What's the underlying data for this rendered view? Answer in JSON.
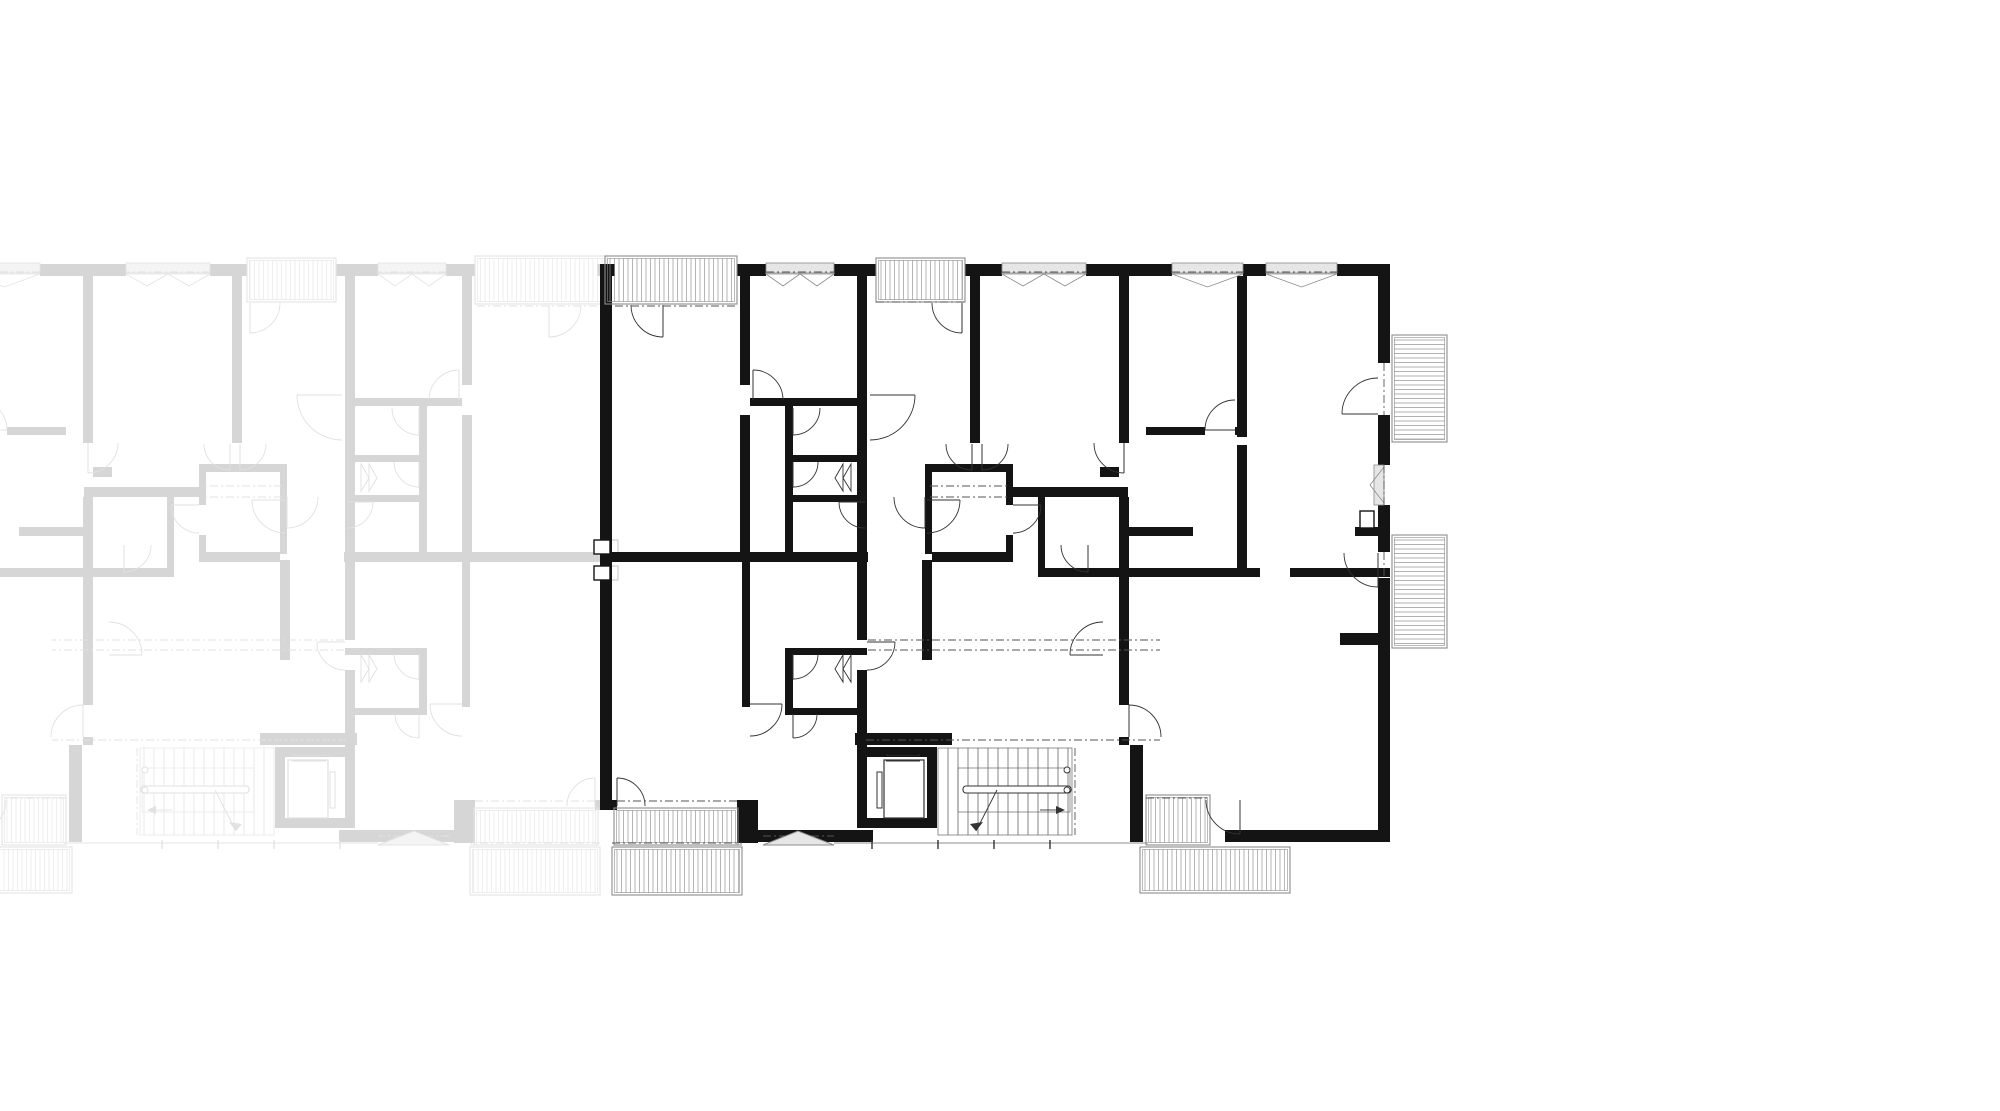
{
  "canvas": {
    "width": 2000,
    "height": 1111,
    "background": "#ffffff"
  },
  "drawing": {
    "kind": "architectural-floor-plan",
    "mirror_axis_x": 606,
    "palette": {
      "wall": "#141414",
      "line": "#333333",
      "thin": "#666666",
      "gray": "#8c8c8c",
      "grayFill": "#e6e6e6",
      "hatch": "#979797",
      "dash": "#555555",
      "faded_wall": "#d6d6d6",
      "faded_line": "#e1e1e1",
      "faded_thin": "#e5e5e5",
      "faded_gray": "#e3e3e3",
      "faded_grayFill": "#f4f4f4",
      "faded_hatch": "#e9e9e9",
      "faded_dash": "#e2e2e2"
    },
    "walls": [
      [
        600,
        264,
        12,
        546
      ],
      [
        600,
        264,
        15,
        12
      ],
      [
        737,
        264,
        29,
        12
      ],
      [
        834,
        264,
        42,
        12
      ],
      [
        965,
        264,
        37,
        12
      ],
      [
        1086,
        264,
        86,
        12
      ],
      [
        1243,
        264,
        23,
        12
      ],
      [
        1337,
        264,
        53,
        12
      ],
      [
        1378,
        264,
        12,
        99
      ],
      [
        1378,
        415,
        12,
        50
      ],
      [
        1378,
        505,
        12,
        47
      ],
      [
        1378,
        578,
        12,
        264
      ],
      [
        605,
        800,
        12,
        10
      ],
      [
        737,
        800,
        21,
        43
      ],
      [
        758,
        830,
        76,
        12
      ],
      [
        834,
        830,
        39,
        12
      ],
      [
        1225,
        830,
        165,
        12
      ],
      [
        740,
        276,
        10,
        109
      ],
      [
        740,
        415,
        10,
        137
      ],
      [
        742,
        562,
        8,
        145
      ],
      [
        857,
        276,
        10,
        286
      ],
      [
        857,
        562,
        10,
        78
      ],
      [
        857,
        670,
        10,
        158
      ],
      [
        922,
        560,
        10,
        100
      ],
      [
        970,
        276,
        10,
        167
      ],
      [
        1119,
        276,
        10,
        167
      ],
      [
        1119,
        497,
        10,
        208
      ],
      [
        1119,
        737,
        10,
        8
      ],
      [
        1130,
        745,
        13,
        97
      ],
      [
        1237,
        276,
        10,
        161
      ],
      [
        1237,
        445,
        10,
        130
      ],
      [
        605,
        552,
        263,
        10
      ],
      [
        932,
        552,
        81,
        10
      ],
      [
        925,
        464,
        88,
        8
      ],
      [
        925,
        470,
        7,
        84
      ],
      [
        1006,
        464,
        7,
        41
      ],
      [
        1006,
        535,
        7,
        27
      ],
      [
        1010,
        487,
        118,
        10
      ],
      [
        1146,
        427,
        59,
        8
      ],
      [
        1235,
        427,
        12,
        8
      ],
      [
        1128,
        527,
        65,
        9
      ],
      [
        1355,
        527,
        35,
        9
      ],
      [
        1038,
        497,
        7,
        80
      ],
      [
        1038,
        568,
        222,
        9
      ],
      [
        1290,
        568,
        100,
        9
      ],
      [
        1340,
        633,
        38,
        12
      ],
      [
        750,
        398,
        117,
        8
      ],
      [
        785,
        400,
        8,
        152
      ],
      [
        793,
        455,
        74,
        7
      ],
      [
        790,
        495,
        77,
        7
      ],
      [
        785,
        648,
        8,
        67
      ],
      [
        785,
        648,
        82,
        7
      ],
      [
        785,
        708,
        82,
        7
      ],
      [
        1100,
        467,
        19,
        10
      ],
      [
        855,
        733,
        97,
        12
      ],
      [
        927,
        747,
        10,
        81
      ],
      [
        866,
        747,
        71,
        10
      ],
      [
        866,
        818,
        71,
        10
      ]
    ],
    "outline_rects": [
      [
        594,
        540,
        16,
        14
      ],
      [
        594,
        566,
        16,
        14
      ],
      [
        1360,
        511,
        14,
        17
      ]
    ],
    "doors": [
      [
        663,
        305,
        32,
        90,
        180
      ],
      [
        962,
        303,
        30,
        90,
        180
      ],
      [
        753,
        400,
        30,
        270,
        0
      ],
      [
        793,
        408,
        27,
        90,
        0
      ],
      [
        793,
        462,
        25,
        90,
        0
      ],
      [
        865,
        502,
        26,
        180,
        90
      ],
      [
        870,
        395,
        45,
        0,
        90
      ],
      [
        972,
        444,
        26,
        90,
        180
      ],
      [
        982,
        444,
        26,
        90,
        0
      ],
      [
        1235,
        430,
        30,
        180,
        270
      ],
      [
        1378,
        414,
        36,
        180,
        270
      ],
      [
        1378,
        553,
        34,
        90,
        180
      ],
      [
        867,
        642,
        28,
        0,
        90
      ],
      [
        750,
        704,
        32,
        0,
        90
      ],
      [
        793,
        654,
        25,
        90,
        0
      ],
      [
        793,
        714,
        24,
        90,
        0
      ],
      [
        617,
        806,
        28,
        270,
        0
      ],
      [
        1240,
        800,
        34,
        90,
        180
      ],
      [
        1124,
        443,
        30,
        90,
        180
      ],
      [
        927,
        500,
        33,
        0,
        90
      ],
      [
        925,
        497,
        31,
        90,
        180
      ],
      [
        1088,
        545,
        27,
        90,
        180
      ],
      [
        1013,
        505,
        28,
        0,
        90
      ],
      [
        1103,
        655,
        33,
        180,
        270
      ],
      [
        1129,
        737,
        32,
        270,
        0
      ]
    ],
    "folds": [
      [
        843,
        464,
        843,
        491,
        835,
        478
      ],
      [
        851,
        464,
        851,
        491,
        843,
        478
      ],
      [
        843,
        655,
        843,
        682,
        835,
        669
      ],
      [
        851,
        655,
        851,
        682,
        843,
        669
      ]
    ],
    "balconies": [
      {
        "x": 605,
        "y": 256,
        "w": 132,
        "h": 48,
        "dir": "v"
      },
      {
        "x": 876,
        "y": 258,
        "w": 89,
        "h": 44,
        "dir": "v"
      },
      {
        "x": 1392,
        "y": 335,
        "w": 55,
        "h": 107,
        "dir": "h"
      },
      {
        "x": 1392,
        "y": 535,
        "w": 55,
        "h": 113,
        "dir": "h"
      },
      {
        "x": 614,
        "y": 808,
        "w": 124,
        "h": 37,
        "dir": "v"
      },
      {
        "x": 612,
        "y": 847,
        "w": 130,
        "h": 48,
        "dir": "v"
      },
      {
        "x": 1146,
        "y": 795,
        "w": 64,
        "h": 50,
        "dir": "v"
      },
      {
        "x": 1140,
        "y": 847,
        "w": 150,
        "h": 46,
        "dir": "v"
      }
    ],
    "windows": [
      {
        "x": 766,
        "y": 266,
        "w": 68,
        "tri": 2
      },
      {
        "x": 1002,
        "y": 266,
        "w": 84,
        "tri": 2
      },
      {
        "x": 1172,
        "y": 266,
        "w": 71,
        "tri": 1
      },
      {
        "x": 1266,
        "y": 266,
        "w": 71,
        "tri": 1
      },
      {
        "x": 1374,
        "y": 465,
        "h": 40,
        "tri": 1,
        "vert": true
      }
    ],
    "dashdot": [
      [
        615,
        306,
        737,
        306
      ],
      [
        876,
        302,
        965,
        302
      ],
      [
        766,
        272,
        834,
        272
      ],
      [
        1002,
        272,
        1086,
        272
      ],
      [
        1172,
        272,
        1243,
        272
      ],
      [
        1266,
        272,
        1337,
        272
      ],
      [
        1384,
        363,
        1384,
        415
      ],
      [
        1384,
        465,
        1384,
        505
      ],
      [
        1384,
        552,
        1384,
        578
      ],
      [
        868,
        640,
        1160,
        640
      ],
      [
        868,
        650,
        1160,
        650
      ],
      [
        866,
        740,
        1160,
        740
      ],
      [
        1075,
        748,
        1075,
        835
      ],
      [
        617,
        801,
        737,
        801
      ],
      [
        612,
        843,
        742,
        843
      ],
      [
        1146,
        798,
        1210,
        798
      ],
      [
        763,
        836,
        834,
        836
      ],
      [
        930,
        486,
        1010,
        486
      ],
      [
        930,
        497,
        1010,
        497
      ]
    ],
    "thin_lines": [
      [
        834,
        843,
        1148,
        843
      ],
      [
        614,
        845,
        742,
        845
      ]
    ],
    "ticks": [
      [
        872,
        840,
        872,
        849
      ],
      [
        938,
        840,
        938,
        849
      ],
      [
        994,
        840,
        994,
        849
      ],
      [
        1050,
        840,
        1050,
        849
      ]
    ],
    "stairs": {
      "x": 938,
      "y": 748,
      "w": 134,
      "h": 87,
      "step": 10,
      "landing": [
        958,
        768,
        112,
        44
      ],
      "rail": {
        "x": 963,
        "y": 786,
        "w": 108,
        "h": 7
      },
      "circles": [
        [
          1067,
          770
        ],
        [
          1067,
          790
        ]
      ],
      "arrow_line": [
        997,
        790,
        976,
        831
      ],
      "arrow_head": [
        [
          976,
          831
        ],
        [
          983,
          822
        ],
        [
          970,
          824
        ]
      ],
      "arrow2_line": [
        1040,
        810,
        1056,
        810
      ],
      "arrow2_head": [
        [
          1056,
          806
        ],
        [
          1065,
          810
        ],
        [
          1056,
          814
        ]
      ]
    },
    "elevator": {
      "car": [
        884,
        760,
        40,
        58
      ],
      "door_lines": [
        [
          886,
          755,
          920,
          755
        ],
        [
          886,
          761,
          920,
          761
        ]
      ],
      "weight": [
        888,
        749,
        30,
        6
      ],
      "rail": [
        877,
        772,
        5,
        36
      ]
    },
    "canopy": {
      "points": [
        [
          763,
          845
        ],
        [
          798,
          831
        ],
        [
          834,
          845
        ]
      ]
    }
  }
}
